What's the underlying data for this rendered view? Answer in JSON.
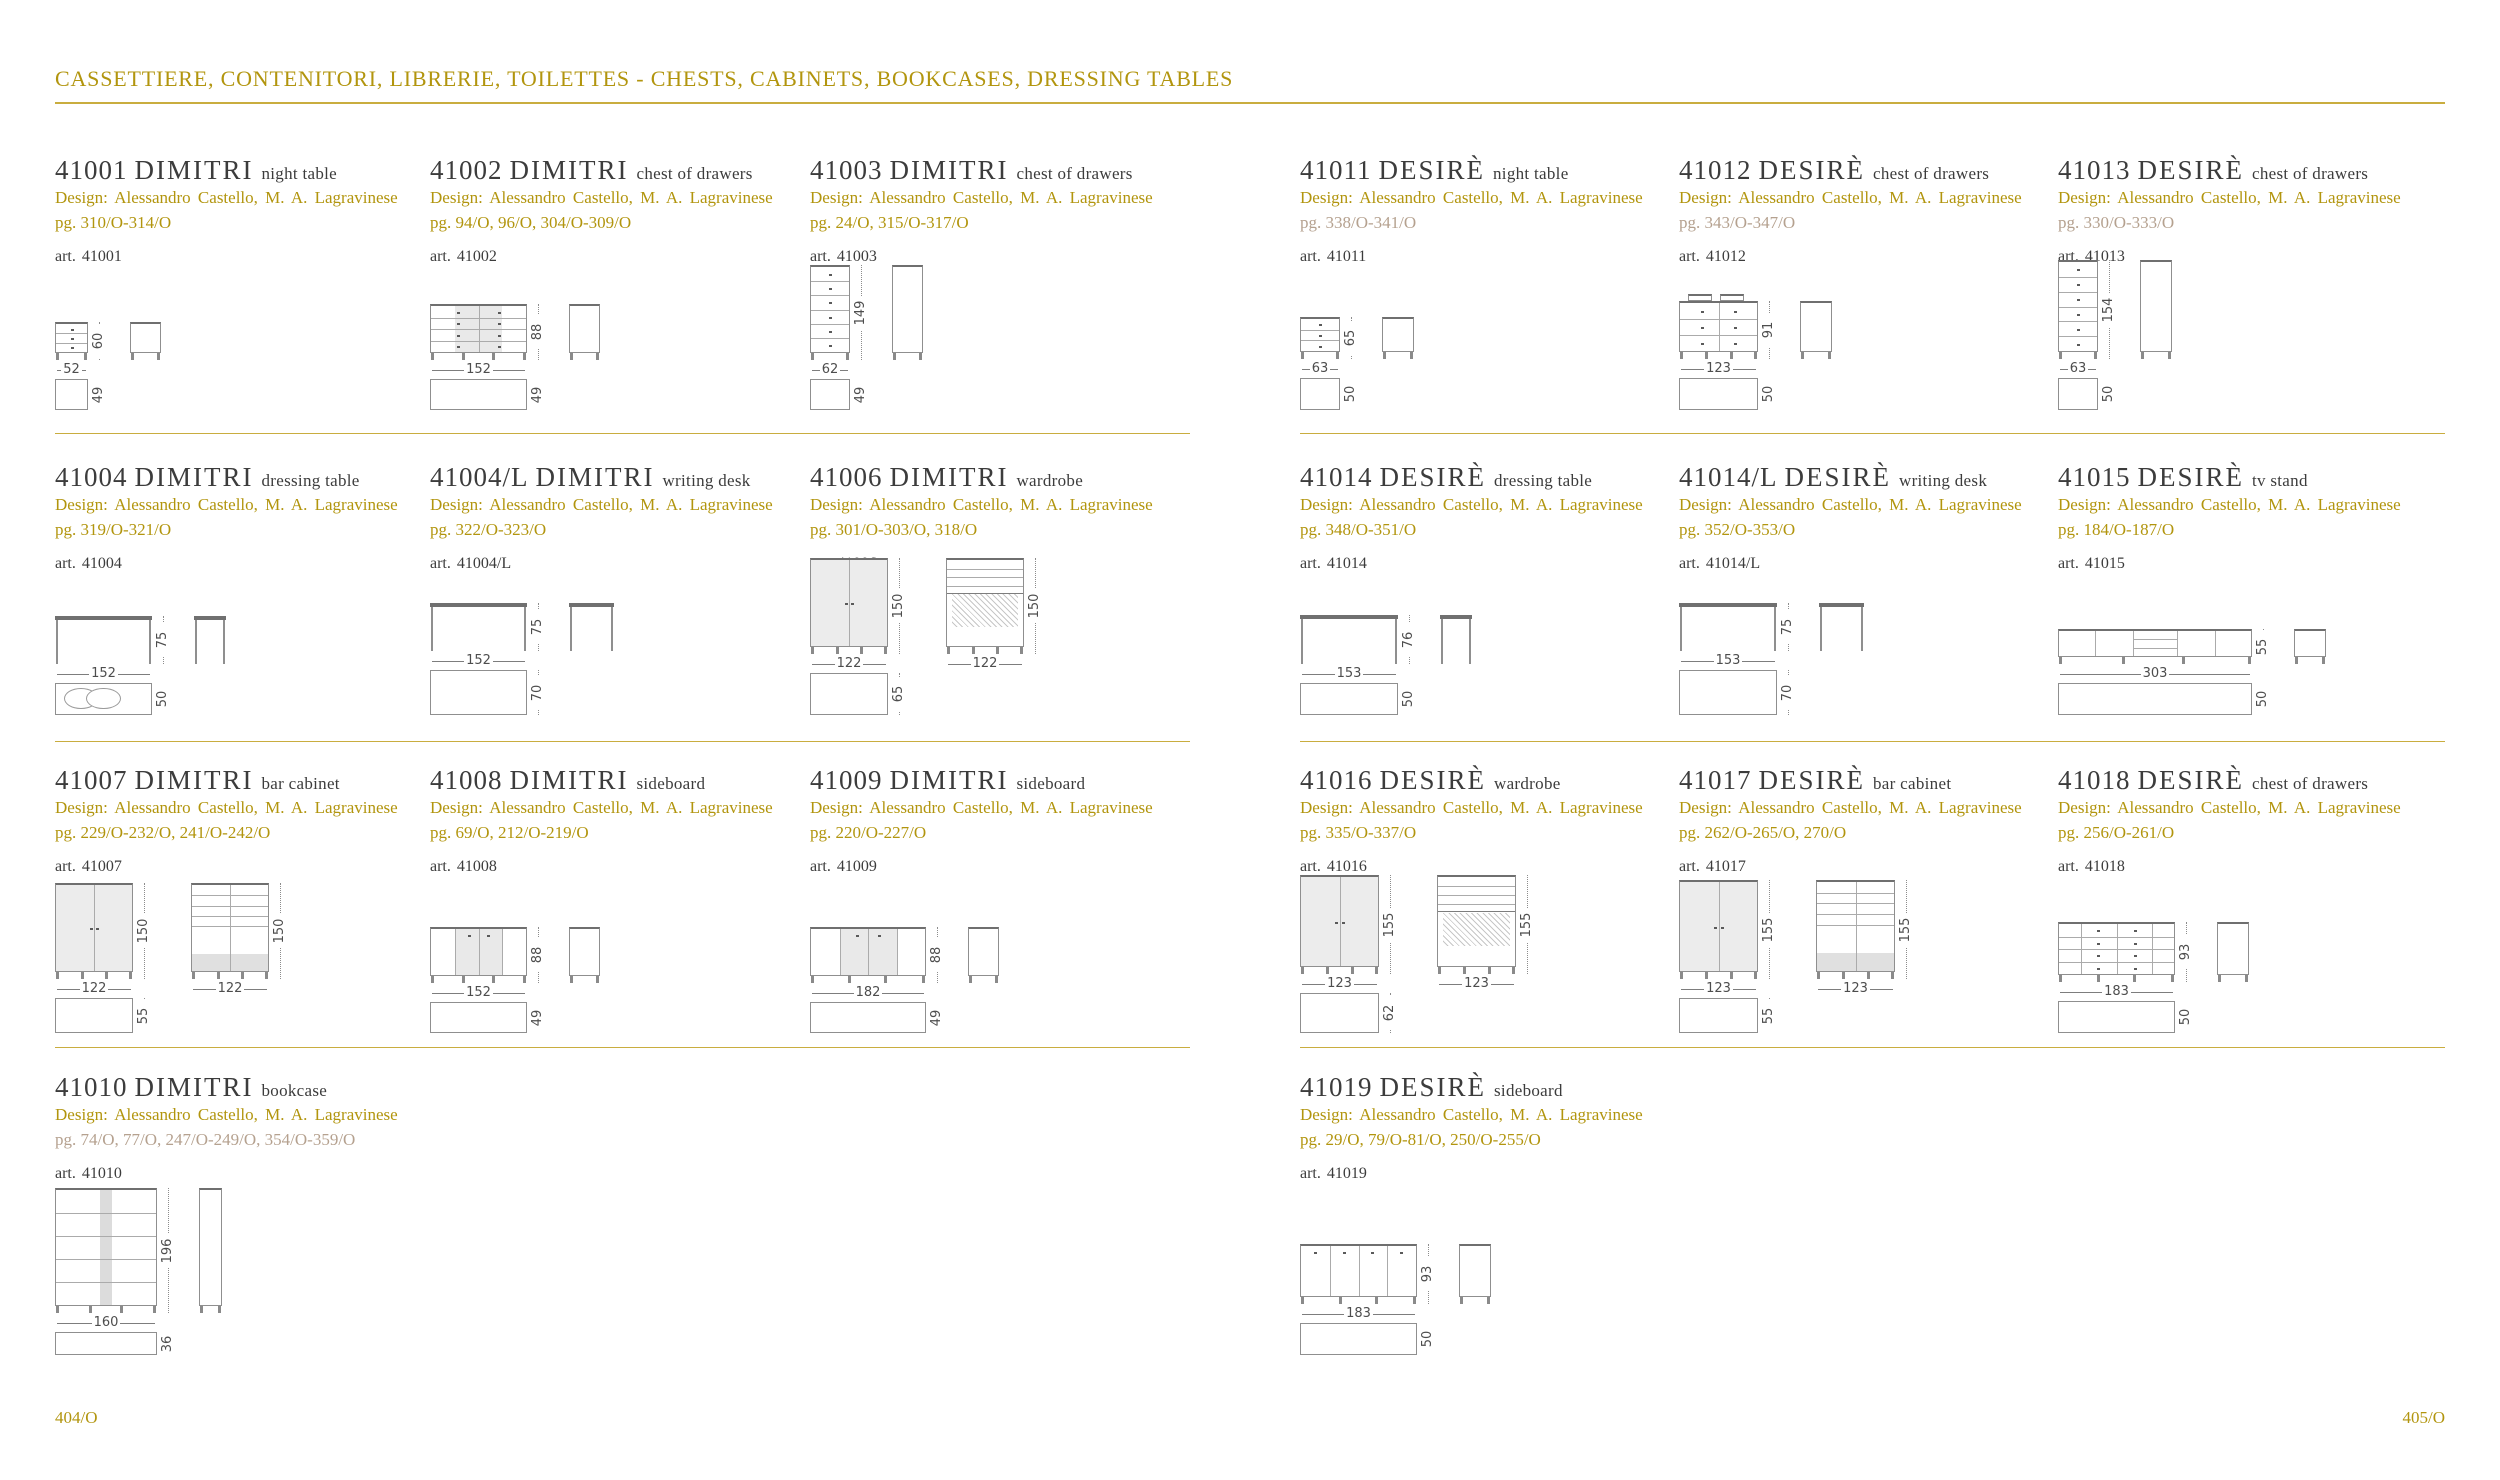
{
  "header": {
    "title": "CASSETTIERE, CONTENITORI, LIBRERIE, TOILETTES - CHESTS, CABINETS, BOOKCASES, DRESSING TABLES"
  },
  "footer": {
    "left_page_number": "404/O",
    "right_page_number": "405/O"
  },
  "design_credit": "Design:  Alessandro Castello, M. A. Lagravinese",
  "colors": {
    "gold": "#b2950e",
    "rule_gold": "#c9ad3f",
    "muted_pg": "#b5a18f",
    "text_dark": "#3c3c3c"
  },
  "products": {
    "left": [
      {
        "code": "41001",
        "name": "DIMITRI",
        "type": "night table",
        "pg": "pg. 310/O-314/O",
        "pg_muted": false,
        "art": "art. 41001",
        "row": 0,
        "col": 0,
        "drawing": {
          "kind": "nightstand",
          "w": 52,
          "h": 60,
          "d": 49
        }
      },
      {
        "code": "41002",
        "name": "DIMITRI",
        "type": "chest of drawers",
        "pg": "pg. 94/O, 96/O, 304/O-309/O",
        "pg_muted": false,
        "art": "art. 41002",
        "row": 0,
        "col": 1,
        "drawing": {
          "kind": "chest2col",
          "rows": 4,
          "shade": true,
          "w": 152,
          "h": 88,
          "d": 49
        }
      },
      {
        "code": "41003",
        "name": "DIMITRI",
        "type": "chest of drawers",
        "pg": "pg. 24/O, 315/O-317/O",
        "pg_muted": false,
        "art": "art. 41003",
        "row": 0,
        "col": 2,
        "drawing": {
          "kind": "tallboy",
          "rows": 6,
          "w": 62,
          "h": 149,
          "d": 49
        }
      },
      {
        "code": "41004",
        "name": "DIMITRI",
        "type": "dressing table",
        "pg": "pg. 319/O-321/O",
        "pg_muted": false,
        "art": "art. 41004",
        "row": 1,
        "col": 0,
        "drawing": {
          "kind": "dressing",
          "ovals": true,
          "w": 152,
          "h": 75,
          "d": 50
        }
      },
      {
        "code": "41004/L",
        "name": "DIMITRI",
        "type": "writing desk",
        "pg": "pg. 322/O-323/O",
        "pg_muted": false,
        "art": "art. 41004/L",
        "row": 1,
        "col": 1,
        "drawing": {
          "kind": "desk",
          "w": 152,
          "h": 75,
          "d": 70
        }
      },
      {
        "code": "41006",
        "name": "DIMITRI",
        "type": "wardrobe",
        "pg": "pg. 301/O-303/O, 318/O",
        "pg_muted": false,
        "art": "art. 41006",
        "row": 1,
        "col": 2,
        "drawing": {
          "kind": "wardrobe2",
          "w": 122,
          "h": 150,
          "d": 65
        }
      },
      {
        "code": "41007",
        "name": "DIMITRI",
        "type": "bar cabinet",
        "pg": "pg. 229/O-232/O, 241/O-242/O",
        "pg_muted": false,
        "art": "art. 41007",
        "row": 2,
        "col": 0,
        "drawing": {
          "kind": "barcab2",
          "w": 122,
          "h": 150,
          "d": 55
        }
      },
      {
        "code": "41008",
        "name": "DIMITRI",
        "type": "sideboard",
        "pg": "pg. 69/O, 212/O-219/O",
        "pg_muted": false,
        "art": "art. 41008",
        "row": 2,
        "col": 1,
        "drawing": {
          "kind": "sideboard",
          "shade": true,
          "w": 152,
          "h": 88,
          "d": 49
        }
      },
      {
        "code": "41009",
        "name": "DIMITRI",
        "type": "sideboard",
        "pg": "pg. 220/O-227/O",
        "pg_muted": false,
        "art": "art. 41009",
        "row": 2,
        "col": 2,
        "drawing": {
          "kind": "sideboard",
          "shade": true,
          "w": 182,
          "h": 88,
          "d": 49
        }
      },
      {
        "code": "41010",
        "name": "DIMITRI",
        "type": "bookcase",
        "pg": "pg. 74/O, 77/O, 247/O-249/O, 354/O-359/O",
        "pg_muted": true,
        "art": "art. 41010",
        "row": 3,
        "col": 0,
        "drawing": {
          "kind": "bookcase",
          "w": 160,
          "h": 196,
          "d": 36
        }
      }
    ],
    "right": [
      {
        "code": "41011",
        "name": "DESIRÈ",
        "type": "night table",
        "pg": "pg. 338/O-341/O",
        "pg_muted": true,
        "art": "art. 41011",
        "row": 0,
        "col": 0,
        "drawing": {
          "kind": "nightstand",
          "w": 63,
          "h": 65,
          "d": 50
        }
      },
      {
        "code": "41012",
        "name": "DESIRÈ",
        "type": "chest of drawers",
        "pg": "pg. 343/O-347/O",
        "pg_muted": true,
        "art": "art. 41012",
        "row": 0,
        "col": 1,
        "drawing": {
          "kind": "chest2col",
          "rows": 3,
          "crown": true,
          "w": 123,
          "h": 91,
          "d": 50
        }
      },
      {
        "code": "41013",
        "name": "DESIRÈ",
        "type": "chest of drawers",
        "pg": "pg. 330/O-333/O",
        "pg_muted": true,
        "art": "art. 41013",
        "row": 0,
        "col": 2,
        "drawing": {
          "kind": "tallboy",
          "rows": 6,
          "w": 63,
          "h": 154,
          "d": 50
        }
      },
      {
        "code": "41014",
        "name": "DESIRÈ",
        "type": "dressing table",
        "pg": "pg. 348/O-351/O",
        "pg_muted": false,
        "art": "art. 41014",
        "row": 1,
        "col": 0,
        "drawing": {
          "kind": "dressing",
          "w": 153,
          "h": 76,
          "d": 50
        }
      },
      {
        "code": "41014/L",
        "name": "DESIRÈ",
        "type": "writing desk",
        "pg": "pg. 352/O-353/O",
        "pg_muted": false,
        "art": "art. 41014/L",
        "row": 1,
        "col": 1,
        "drawing": {
          "kind": "desk",
          "w": 153,
          "h": 75,
          "d": 70
        }
      },
      {
        "code": "41015",
        "name": "DESIRÈ",
        "type": "tv stand",
        "pg": "pg. 184/O-187/O",
        "pg_muted": false,
        "art": "art. 41015",
        "row": 1,
        "col": 2,
        "drawing": {
          "kind": "tvstand",
          "w": 303,
          "h": 55,
          "d": 50
        }
      },
      {
        "code": "41016",
        "name": "DESIRÈ",
        "type": "wardrobe",
        "pg": "pg. 335/O-337/O",
        "pg_muted": false,
        "art": "art. 41016",
        "row": 2,
        "col": 0,
        "drawing": {
          "kind": "wardrobe2",
          "w": 123,
          "h": 155,
          "d": 62
        }
      },
      {
        "code": "41017",
        "name": "DESIRÈ",
        "type": "bar cabinet",
        "pg": "pg. 262/O-265/O, 270/O",
        "pg_muted": false,
        "art": "art. 41017",
        "row": 2,
        "col": 1,
        "drawing": {
          "kind": "barcab2",
          "w": 123,
          "h": 155,
          "d": 55
        }
      },
      {
        "code": "41018",
        "name": "DESIRÈ",
        "type": "chest of drawers",
        "pg": "pg. 256/O-261/O",
        "pg_muted": false,
        "art": "art. 41018",
        "row": 2,
        "col": 2,
        "drawing": {
          "kind": "chestwide",
          "rows": 4,
          "w": 183,
          "h": 93,
          "d": 50
        }
      },
      {
        "code": "41019",
        "name": "DESIRÈ",
        "type": "sideboard",
        "pg": "pg. 29/O, 79/O-81/O, 250/O-255/O",
        "pg_muted": false,
        "art": "art. 41019",
        "row": 3,
        "col": 0,
        "drawing": {
          "kind": "sideboard4",
          "w": 183,
          "h": 93,
          "d": 50
        }
      }
    ]
  }
}
